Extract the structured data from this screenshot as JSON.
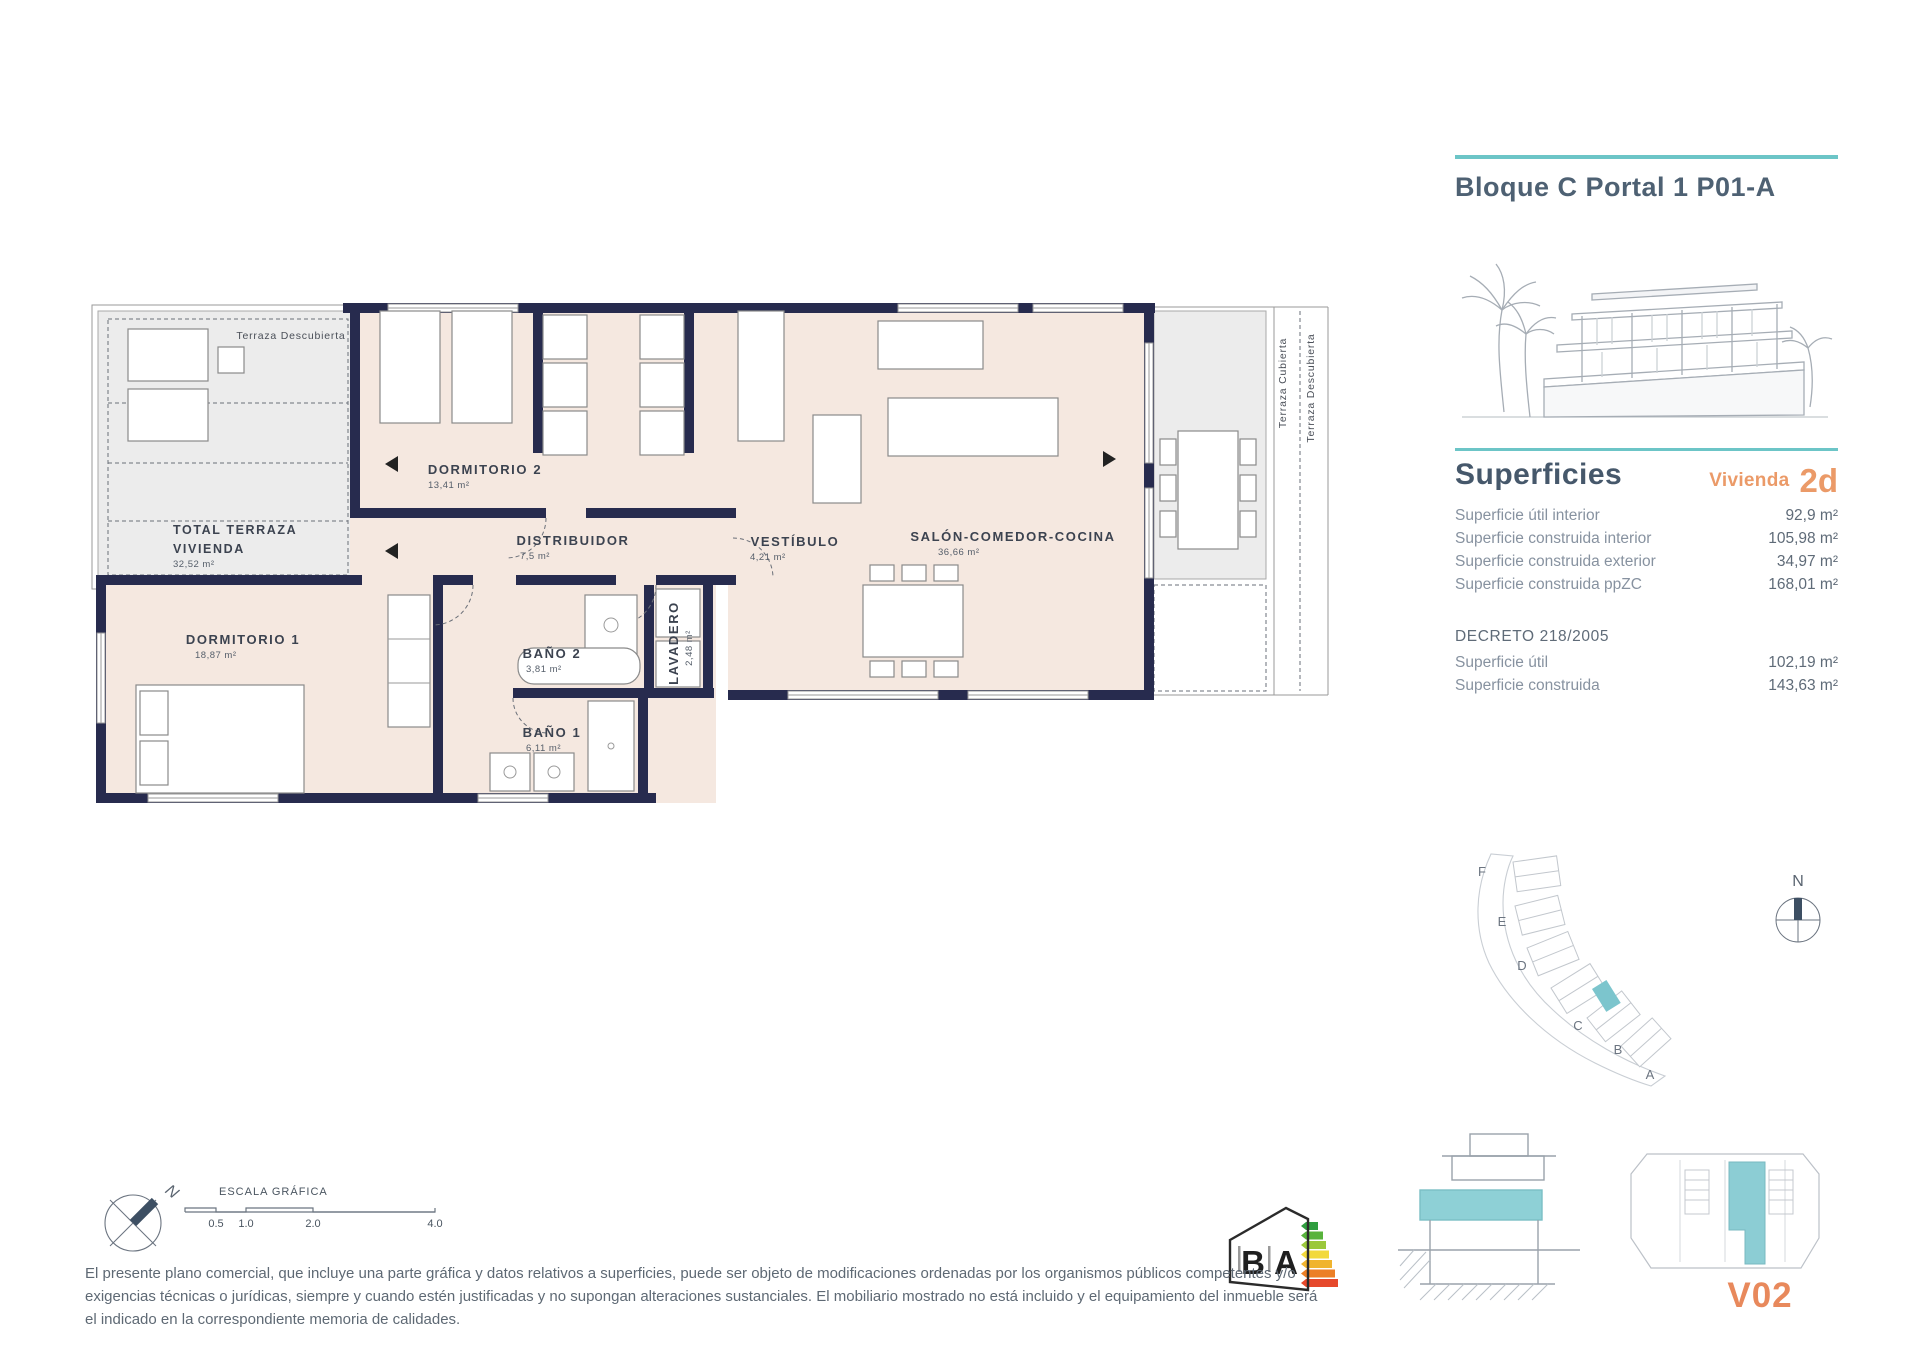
{
  "header": {
    "title": "Bloque C Portal 1 P01-A"
  },
  "superficies": {
    "heading": "Superficies",
    "vivienda_label": "Vivienda",
    "vivienda_value": "2d",
    "rows": [
      {
        "label": "Superficie útil interior",
        "value": "92,9 m²"
      },
      {
        "label": "Superficie construida interior",
        "value": "105,98 m²"
      },
      {
        "label": "Superficie construida exterior",
        "value": "34,97 m²"
      },
      {
        "label": "Superficie construida ppZC",
        "value": "168,01 m²"
      }
    ],
    "decreto": {
      "heading": "DECRETO 218/2005",
      "rows": [
        {
          "label": "Superficie útil",
          "value": "102,19 m²"
        },
        {
          "label": "Superficie construida",
          "value": "143,63 m²"
        }
      ]
    }
  },
  "floorplan": {
    "terraza_top": {
      "label": "Terraza Descubierta"
    },
    "total_terraza": {
      "line1": "TOTAL TERRAZA",
      "line2": "VIVIENDA",
      "area": "32,52 m²"
    },
    "dormitorio2": {
      "name": "DORMITORIO 2",
      "area": "13,41 m²"
    },
    "distribuidor": {
      "name": "DISTRIBUIDOR",
      "area": "7,5 m²"
    },
    "vestibulo": {
      "name": "VESTÍBULO",
      "area": "4,21 m²"
    },
    "salon": {
      "name": "SALÓN-COMEDOR-COCINA",
      "area": "36,66 m²"
    },
    "dormitorio1": {
      "name": "DORMITORIO 1",
      "area": "18,87 m²"
    },
    "bano2": {
      "name": "BAÑO 2",
      "area": "3,81 m²"
    },
    "lavadero": {
      "name": "LAVADERO",
      "area": "2,48 m²"
    },
    "bano1": {
      "name": "BAÑO 1",
      "area": "6,11 m²"
    },
    "terraza_cubierta": {
      "label": "Terraza Cubierta"
    },
    "terraza_descubierta_right": {
      "label": "Terraza Descubierta"
    }
  },
  "siteplan": {
    "north": "N",
    "blocks": [
      "F",
      "E",
      "D",
      "C",
      "B",
      "A"
    ]
  },
  "compass": {
    "north": "N"
  },
  "scalebar": {
    "title": "ESCALA GRÁFICA",
    "ticks": [
      "0.5",
      "1.0",
      "2.0",
      "4.0"
    ]
  },
  "energy": {
    "letter_b": "B",
    "letter_a": "A"
  },
  "footer": {
    "lines": [
      "El presente plano comercial, que incluye una parte gráfica y datos relativos a superficies, puede ser objeto de modificaciones ordenadas por los organismos públicos competentes y/o",
      "exigencias técnicas o jurídicas, siempre y cuando estén justificadas y no supongan alteraciones sustanciales. El mobiliario mostrado no está incluido y el equipamiento del inmueble será",
      "el indicado en la correspondiente memoria de calidades."
    ],
    "version": "V02"
  },
  "colors": {
    "accent_teal": "#6cc5c7",
    "accent_orange": "#e8925f",
    "wall_navy": "#272b4e",
    "room_fill": "#f5e8e0",
    "terrace_fill": "#ececec",
    "title_slate": "#4e6173"
  }
}
